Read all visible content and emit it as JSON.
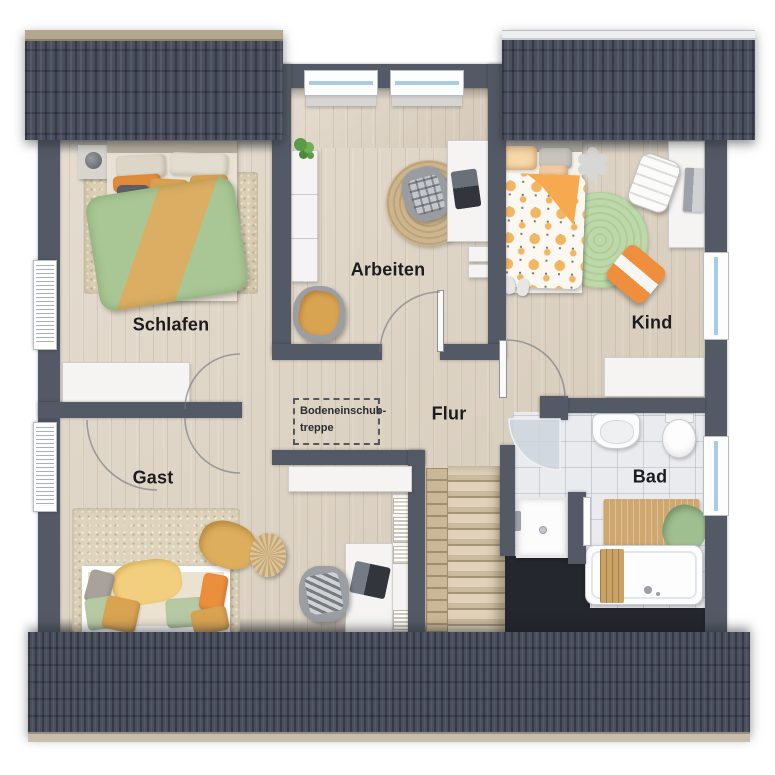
{
  "plan": {
    "type": "floor-plan-top-view",
    "rooms": [
      {
        "id": "schlafen",
        "label": "Schlafen"
      },
      {
        "id": "arbeiten",
        "label": "Arbeiten"
      },
      {
        "id": "kind",
        "label": "Kind"
      },
      {
        "id": "gast",
        "label": "Gast"
      },
      {
        "id": "flur",
        "label": "Flur"
      },
      {
        "id": "bad",
        "label": "Bad"
      }
    ],
    "annotation": {
      "id": "bodeneinschubtreppe",
      "line1": "Bodeneinschub-",
      "line2": "treppe"
    }
  },
  "colors": {
    "roof": "#4a4f5e",
    "roof_ridge_tan": "#b3a78e",
    "roof_ridge_white": "#eceef0",
    "wall": "#545a65",
    "wood_floor": "#dcd1c0",
    "bath_tiles": "#e9ebee",
    "stair_tread": "#d8c9ae",
    "void_dark": "#24272d",
    "accent_orange": "#ec8f3c",
    "accent_mustard": "#d9a14e",
    "accent_green": "#a9c795",
    "rug_jute": "#c9b28d",
    "rug_green": "#bcd8a9",
    "window_glass": "#a9cbe3"
  }
}
